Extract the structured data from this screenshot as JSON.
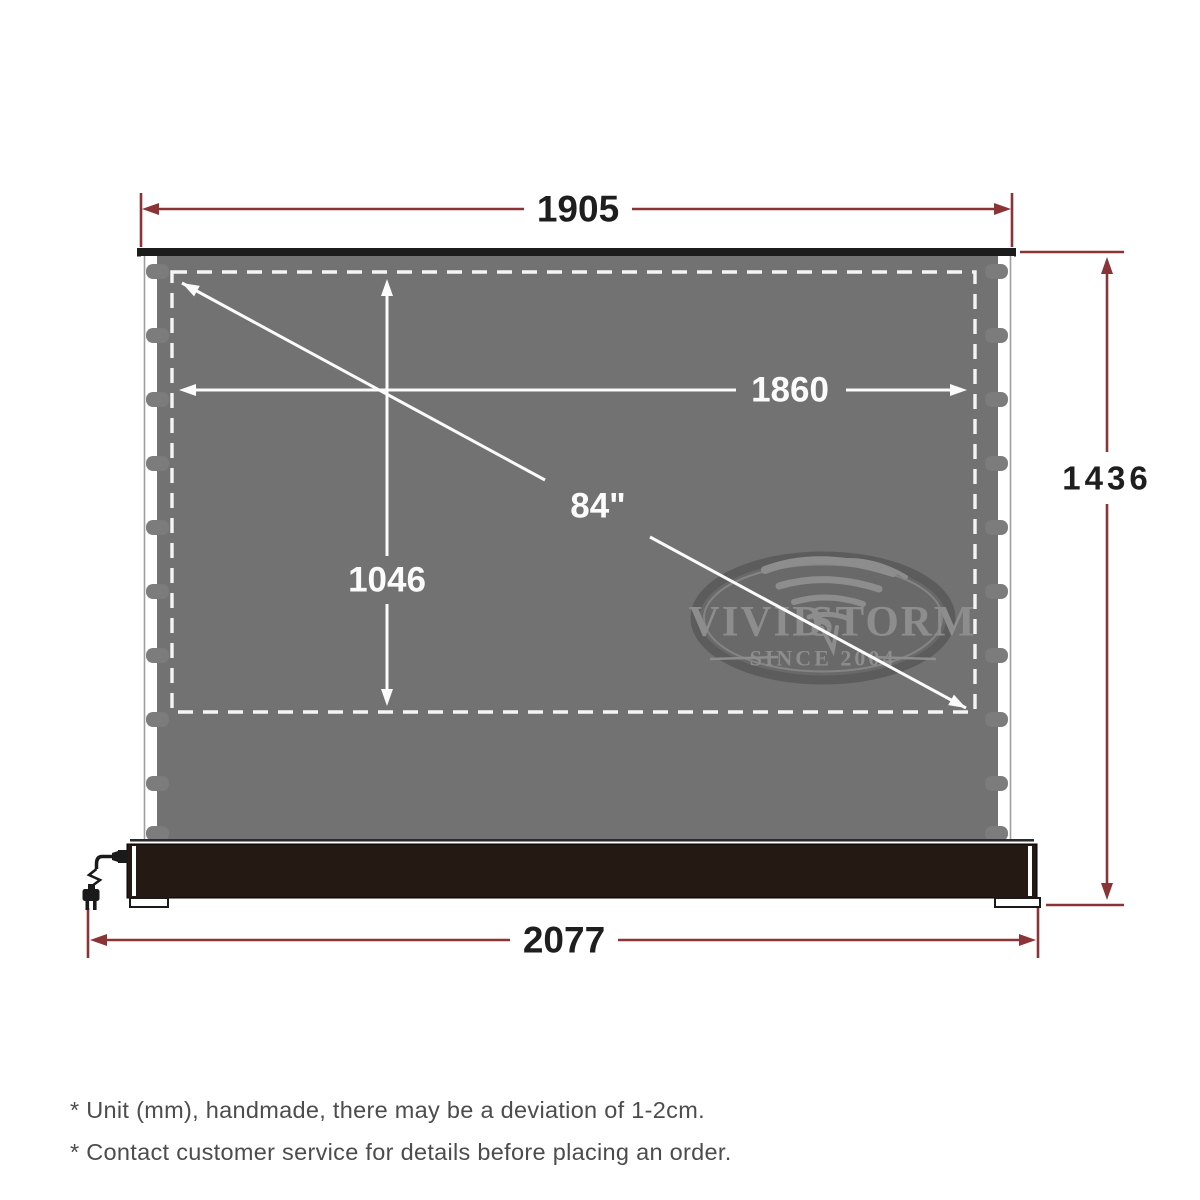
{
  "diagram": {
    "dimensions": {
      "top_width": "1905",
      "viewing_width": "1860",
      "viewing_height": "1046",
      "diagonal": "84\"",
      "total_height": "1436",
      "base_width": "2077"
    },
    "logo": {
      "brand_left": "VIVID",
      "brand_right": "STORM",
      "tagline": "SINCE 2004"
    },
    "notes": [
      "* Unit (mm), handmade, there may be a deviation of 1-2cm.",
      "* Contact customer service for details before placing an order."
    ],
    "colors": {
      "dimension_red": "#8a3437",
      "screen_gray": "#727272",
      "housing_black": "#241913",
      "arrow_white": "#fbfbfb"
    }
  }
}
